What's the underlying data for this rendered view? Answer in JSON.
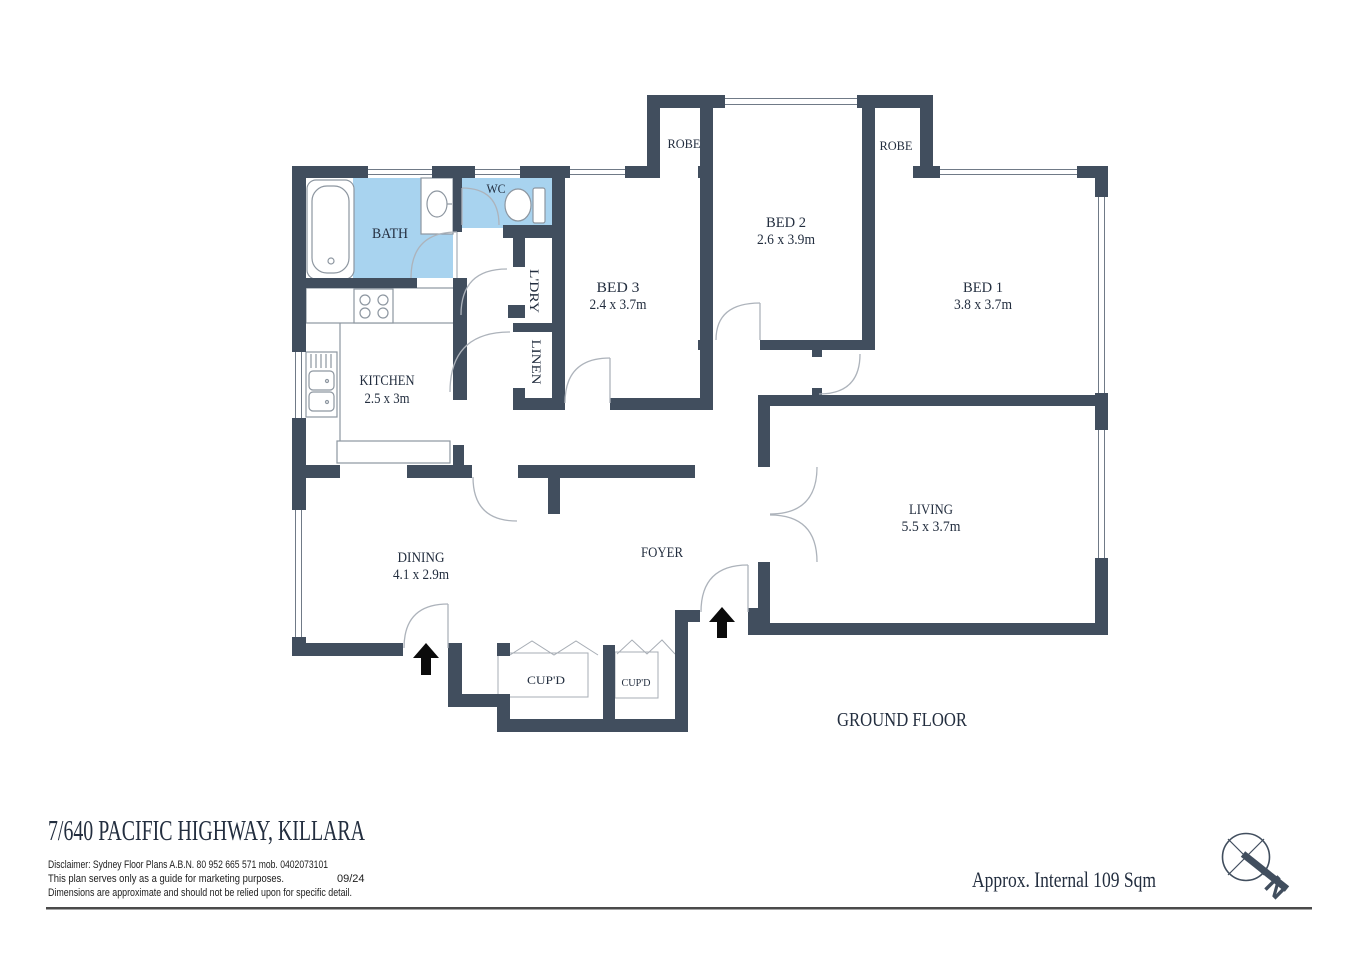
{
  "plan": {
    "rooms": {
      "bath": {
        "label": "BATH"
      },
      "wc": {
        "label": "WC"
      },
      "laundry": {
        "label": "L'DRY"
      },
      "linen": {
        "label": "LINEN"
      },
      "kitchen": {
        "label": "KITCHEN",
        "dims": "2.5 x 3m"
      },
      "bed3": {
        "label": "BED 3",
        "dims": "2.4 x 3.7m"
      },
      "bed2": {
        "label": "BED 2",
        "dims": "2.6 x 3.9m"
      },
      "bed1": {
        "label": "BED 1",
        "dims": "3.8 x 3.7m"
      },
      "robe_left": {
        "label": "ROBE"
      },
      "robe_right": {
        "label": "ROBE"
      },
      "living": {
        "label": "LIVING",
        "dims": "5.5 x 3.7m"
      },
      "dining": {
        "label": "DINING",
        "dims": "4.1 x 2.9m"
      },
      "foyer": {
        "label": "FOYER"
      },
      "cupboard_left": {
        "label": "CUP'D"
      },
      "cupboard_right": {
        "label": "CUP'D"
      }
    },
    "floor_label": "GROUND FLOOR",
    "compass": {
      "north_label": "N"
    }
  },
  "footer": {
    "title": "7/640 PACIFIC HIGHWAY, KILLARA",
    "disclaimer_line1": "Disclaimer: Sydney Floor Plans A.B.N. 80 952 665 571  mob. 0402073101",
    "disclaimer_line2": "This plan serves only as a guide for marketing purposes.",
    "disclaimer_date": "09/24",
    "disclaimer_line3": "Dimensions are approximate and should not be relied upon for specific detail.",
    "area_label": "Approx. Internal 109 Sqm"
  },
  "colors": {
    "wall": "#414e5e",
    "wet_area": "#a8d3ef",
    "label_text": "#232e3f",
    "fixture_line": "#8d96a0",
    "door_arc": "#adb3bb",
    "window_line": "#707a87",
    "arrow": "#0b0b0b"
  }
}
